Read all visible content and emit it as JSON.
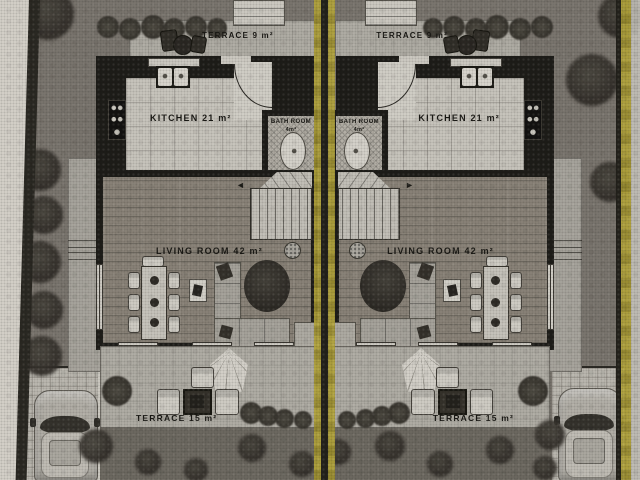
{
  "units": [
    {
      "side": "left",
      "terrace_top_label": "TERRACE 9 m²",
      "kitchen_label": "KITCHEN 21 m²",
      "bath_label": "BATH ROOM",
      "bath_area_label": "4m²",
      "living_label": "LIVING ROOM 42 m²",
      "terrace_bottom_label": "TERRACE 15 m²"
    },
    {
      "side": "right",
      "terrace_top_label": "TERRACE 9 m²",
      "kitchen_label": "KITCHEN 21 m²",
      "bath_label": "BATH ROOM",
      "bath_area_label": "4m²",
      "living_label": "LIVING ROOM 42 m²",
      "terrace_bottom_label": "TERRACE 15 m²"
    }
  ],
  "icons": {
    "stair_arrow": "◄"
  },
  "colors": {
    "ground": "#7b766f",
    "wall": "#1d1c18",
    "kitchen_floor": "#cbc8c0",
    "wood_floor": "#8b8479",
    "terrace_floor": "#b2afa7",
    "boundary_yellow": "#b3a437",
    "garden": "#6e6a62",
    "page_edge": "#d8d4cc"
  }
}
